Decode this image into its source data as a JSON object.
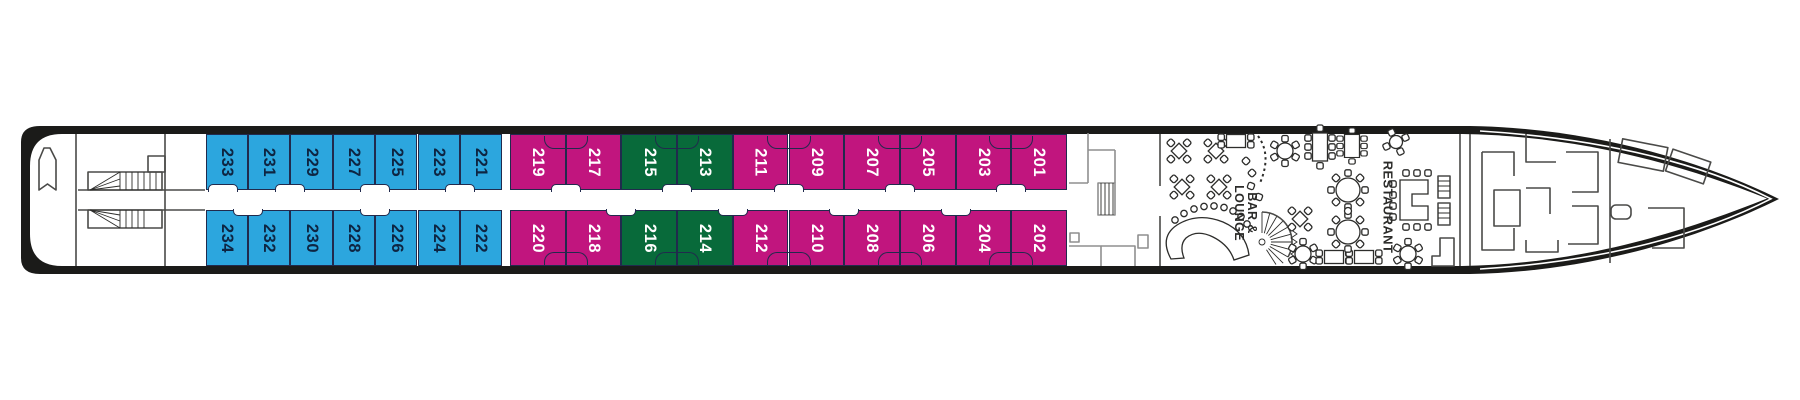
{
  "deck_plan": {
    "background": "#ffffff",
    "hull_color": "#1b1b19",
    "deck_color": "#ffffff",
    "cabin_border_color": "#212a4d"
  },
  "legend_colors": {
    "blue": "#2ca6de",
    "pink": "#c1157e",
    "green": "#086a3a"
  },
  "cabin_text_colors": {
    "blue": "#0e2542",
    "pink": "#ffffff",
    "green": "#ffffff"
  },
  "areas": {
    "bar_lounge_label_line1": "BAR &",
    "bar_lounge_label_line2": "LOUNGE",
    "restaurant_label": "RESTAURANT"
  },
  "cabins": {
    "top_row": [
      {
        "number": "233",
        "category": "blue"
      },
      {
        "number": "231",
        "category": "blue"
      },
      {
        "number": "229",
        "category": "blue"
      },
      {
        "number": "227",
        "category": "blue"
      },
      {
        "number": "225",
        "category": "blue"
      },
      {
        "number": "223",
        "category": "blue"
      },
      {
        "number": "221",
        "category": "blue"
      },
      {
        "number": "219",
        "category": "pink"
      },
      {
        "number": "217",
        "category": "pink"
      },
      {
        "number": "215",
        "category": "green"
      },
      {
        "number": "213",
        "category": "green"
      },
      {
        "number": "211",
        "category": "pink"
      },
      {
        "number": "209",
        "category": "pink"
      },
      {
        "number": "207",
        "category": "pink"
      },
      {
        "number": "205",
        "category": "pink"
      },
      {
        "number": "203",
        "category": "pink"
      },
      {
        "number": "201",
        "category": "pink"
      }
    ],
    "bottom_row": [
      {
        "number": "234",
        "category": "blue"
      },
      {
        "number": "232",
        "category": "blue"
      },
      {
        "number": "230",
        "category": "blue"
      },
      {
        "number": "228",
        "category": "blue"
      },
      {
        "number": "226",
        "category": "blue"
      },
      {
        "number": "224",
        "category": "blue"
      },
      {
        "number": "222",
        "category": "blue"
      },
      {
        "number": "220",
        "category": "pink"
      },
      {
        "number": "218",
        "category": "pink"
      },
      {
        "number": "216",
        "category": "green"
      },
      {
        "number": "214",
        "category": "green"
      },
      {
        "number": "212",
        "category": "pink"
      },
      {
        "number": "210",
        "category": "pink"
      },
      {
        "number": "208",
        "category": "pink"
      },
      {
        "number": "206",
        "category": "pink"
      },
      {
        "number": "204",
        "category": "pink"
      },
      {
        "number": "202",
        "category": "pink"
      }
    ]
  }
}
